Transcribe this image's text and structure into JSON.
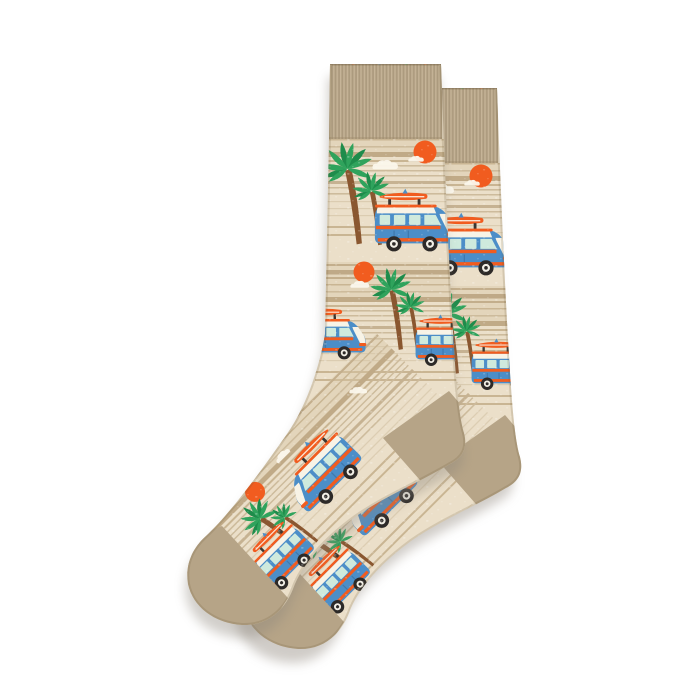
{
  "scene": {
    "type": "product-photo",
    "item": "pair of crew socks, crossed, angled toe to lower-left",
    "description": "Two beige heathered crew socks with a tropical beach knit pattern: blue camper vans with surfboards on roof racks, green palm trees, orange suns, white clouds and tan sand stripes. Solid heathered tan ribbed cuffs, heels and toes. White background with soft drop shadow.",
    "quantity": 2,
    "pattern_motifs": [
      "camper-van-with-surfboard",
      "palm-tree",
      "sun",
      "cloud",
      "sand-stripes"
    ],
    "colors": {
      "background": "#ffffff",
      "sock_base": "#ebdfc9",
      "stripe_light": "#cdbb9c",
      "stripe_dark": "#c3ae8c",
      "dune_band": "#d7c5a5",
      "rib_tan": "#b2a184",
      "rib_highlight": "#c9b89b",
      "heather_tan": "#b6a487",
      "palm_green": "#2fa35c",
      "palm_green_dark": "#1e8c4b",
      "trunk_brown": "#8a5730",
      "accent_orange": "#f15c1f",
      "van_blue": "#4c8ec8",
      "van_blue_dark": "#3c74a8",
      "window_mint": "#cfeadd",
      "cream": "#f8f3e6",
      "wheel_black": "#2d2a28",
      "shadow": "#a9a29a"
    }
  }
}
